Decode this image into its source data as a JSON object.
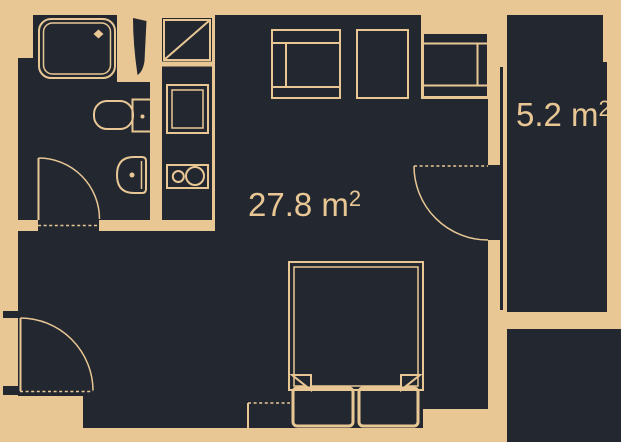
{
  "floorplan": {
    "type": "apartment-floor-plan",
    "background_color": "#e9c795",
    "room_fill_color": "#232830",
    "line_color": "#e9c795",
    "rooms": {
      "main": {
        "area_label": "27.8 m",
        "area_superscript": "2"
      },
      "balcony": {
        "area_label": "5.2 m",
        "area_superscript": "2"
      }
    }
  }
}
